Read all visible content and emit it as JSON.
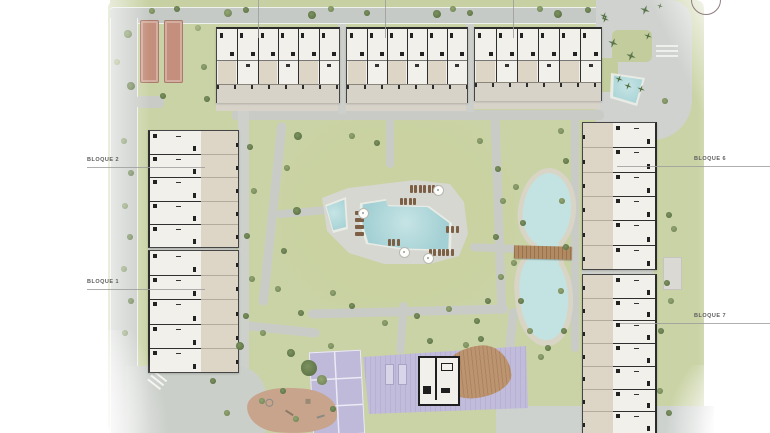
{
  "plan_title": "Residential masterplan",
  "colors": {
    "grass": "#cad3a6",
    "grass_light": "#d2daae",
    "grass_dark": "#c2cc9b",
    "road": "#c6cac6",
    "path": "#c9ccc6",
    "plaza": "#ced1ce",
    "deck": "#d6d7d0",
    "pool_rim": "#e9ebe5",
    "pool": "#a6d2d5",
    "pool_light": "#c6e4e5",
    "sand": "#d9d5c6",
    "lagoon": "#c2e3e1",
    "terrace": "#ddd6c6",
    "room": "#f2f0ea",
    "wall": "#2b2b2b",
    "plinth": "#d8d3c8",
    "purple": "#c2bcdc",
    "purple_line": "#eceaf4",
    "wood": "#bd9470",
    "bridge": "#b28a62",
    "play": "#c7a48b",
    "petanque": "#c48f7c",
    "lounger": "#7d5f46",
    "tree_dark": "#5e7547",
    "tree_mid": "#74885a",
    "tree_light": "#94a471",
    "palm": "#4a663d",
    "label": "#5c5c5c",
    "leader": "#9b9b9b"
  },
  "scene": {
    "labels": [
      {
        "text": "BLOQUE 2",
        "tx": 87,
        "ty": 158,
        "lx1": 87,
        "lx2": 205,
        "ly": 167
      },
      {
        "text": "BLOQUE 1",
        "tx": 87,
        "ty": 280,
        "lx1": 87,
        "lx2": 205,
        "ly": 289
      },
      {
        "text": "BLOQUE 6",
        "tx": 694,
        "ty": 157,
        "lx1": 617,
        "lx2": 770,
        "ly": 166
      },
      {
        "text": "BLOQUE 7",
        "tx": 694,
        "ty": 314,
        "lx1": 620,
        "lx2": 770,
        "ly": 323
      }
    ],
    "top_leaders": [
      258,
      385,
      513
    ],
    "buildings": [
      {
        "id": "bloque-3",
        "x": 216,
        "y": 27,
        "w": 122,
        "h": 73,
        "dir": "h",
        "units": 6
      },
      {
        "id": "bloque-4",
        "x": 346,
        "y": 27,
        "w": 120,
        "h": 73,
        "dir": "h",
        "units": 6
      },
      {
        "id": "bloque-5",
        "x": 474,
        "y": 27,
        "w": 126,
        "h": 71,
        "dir": "h",
        "units": 6
      },
      {
        "id": "bloque-2",
        "x": 148,
        "y": 130,
        "w": 88,
        "h": 116,
        "dir": "v",
        "terrace": "right",
        "units": 5
      },
      {
        "id": "bloque-1",
        "x": 148,
        "y": 250,
        "w": 88,
        "h": 121,
        "dir": "v",
        "terrace": "right",
        "units": 5
      },
      {
        "id": "bloque-6",
        "x": 582,
        "y": 122,
        "w": 72,
        "h": 146,
        "dir": "v",
        "terrace": "left",
        "units": 6
      },
      {
        "id": "bloque-7",
        "x": 582,
        "y": 274,
        "w": 72,
        "h": 159,
        "dir": "v",
        "terrace": "left",
        "units": 7
      }
    ],
    "trees": [
      [
        228,
        13,
        4,
        "m"
      ],
      [
        246,
        10,
        3,
        "d"
      ],
      [
        312,
        15,
        4,
        "d"
      ],
      [
        331,
        9,
        3,
        "m"
      ],
      [
        367,
        13,
        3,
        "d"
      ],
      [
        437,
        14,
        4,
        "d"
      ],
      [
        453,
        9,
        3,
        "m"
      ],
      [
        470,
        13,
        3,
        "d"
      ],
      [
        540,
        9,
        3,
        "m"
      ],
      [
        558,
        14,
        4,
        "d"
      ],
      [
        588,
        10,
        3,
        "d"
      ],
      [
        604,
        16,
        4,
        "p"
      ],
      [
        645,
        10,
        5,
        "p"
      ],
      [
        660,
        6,
        3,
        "p"
      ],
      [
        128,
        34,
        4,
        "m"
      ],
      [
        131,
        86,
        4,
        "d"
      ],
      [
        152,
        11,
        3,
        "m"
      ],
      [
        163,
        96,
        3,
        "d"
      ],
      [
        198,
        28,
        3,
        "l"
      ],
      [
        204,
        67,
        3,
        "m"
      ],
      [
        207,
        99,
        3,
        "d"
      ],
      [
        177,
        9,
        3,
        "d"
      ],
      [
        117,
        62,
        3,
        "l"
      ],
      [
        124,
        141,
        3,
        "m"
      ],
      [
        131,
        173,
        3,
        "d"
      ],
      [
        125,
        206,
        3,
        "m"
      ],
      [
        130,
        237,
        3,
        "d"
      ],
      [
        124,
        269,
        3,
        "m"
      ],
      [
        131,
        301,
        3,
        "d"
      ],
      [
        125,
        333,
        3,
        "m"
      ],
      [
        250,
        147,
        3,
        "d"
      ],
      [
        254,
        191,
        3,
        "m"
      ],
      [
        247,
        236,
        3,
        "d"
      ],
      [
        252,
        279,
        3,
        "m"
      ],
      [
        246,
        316,
        3,
        "d"
      ],
      [
        298,
        136,
        4,
        "d"
      ],
      [
        287,
        168,
        3,
        "m"
      ],
      [
        297,
        211,
        4,
        "d"
      ],
      [
        284,
        251,
        3,
        "d"
      ],
      [
        278,
        289,
        3,
        "m"
      ],
      [
        301,
        313,
        3,
        "d"
      ],
      [
        263,
        333,
        3,
        "m"
      ],
      [
        240,
        346,
        4,
        "d"
      ],
      [
        352,
        136,
        3,
        "m"
      ],
      [
        377,
        143,
        3,
        "d"
      ],
      [
        480,
        141,
        3,
        "m"
      ],
      [
        498,
        169,
        3,
        "d"
      ],
      [
        503,
        201,
        3,
        "m"
      ],
      [
        496,
        237,
        3,
        "d"
      ],
      [
        501,
        277,
        3,
        "m"
      ],
      [
        488,
        301,
        3,
        "d"
      ],
      [
        352,
        306,
        3,
        "d"
      ],
      [
        385,
        323,
        3,
        "m"
      ],
      [
        417,
        316,
        3,
        "d"
      ],
      [
        449,
        309,
        3,
        "m"
      ],
      [
        477,
        321,
        3,
        "d"
      ],
      [
        333,
        293,
        3,
        "m"
      ],
      [
        516,
        187,
        3,
        "m"
      ],
      [
        523,
        223,
        3,
        "d"
      ],
      [
        514,
        263,
        3,
        "m"
      ],
      [
        521,
        301,
        3,
        "d"
      ],
      [
        530,
        331,
        3,
        "m"
      ],
      [
        548,
        348,
        3,
        "d"
      ],
      [
        561,
        131,
        3,
        "m"
      ],
      [
        566,
        161,
        3,
        "d"
      ],
      [
        562,
        201,
        3,
        "m"
      ],
      [
        566,
        247,
        3,
        "d"
      ],
      [
        561,
        291,
        3,
        "m"
      ],
      [
        564,
        331,
        3,
        "d"
      ],
      [
        665,
        101,
        3,
        "m"
      ],
      [
        669,
        215,
        3,
        "d"
      ],
      [
        674,
        229,
        3,
        "m"
      ],
      [
        667,
        283,
        3,
        "d"
      ],
      [
        671,
        301,
        3,
        "m"
      ],
      [
        661,
        331,
        3,
        "d"
      ],
      [
        660,
        391,
        3,
        "m"
      ],
      [
        669,
        413,
        3,
        "d"
      ],
      [
        613,
        43,
        5,
        "p"
      ],
      [
        631,
        56,
        5,
        "p"
      ],
      [
        619,
        79,
        4,
        "p"
      ],
      [
        641,
        89,
        4,
        "p"
      ],
      [
        605,
        19,
        4,
        "p"
      ],
      [
        628,
        86,
        4,
        "p"
      ],
      [
        648,
        36,
        4,
        "p"
      ],
      [
        291,
        353,
        4,
        "d"
      ],
      [
        309,
        368,
        8,
        "d"
      ],
      [
        322,
        380,
        5,
        "m"
      ],
      [
        331,
        346,
        3,
        "m"
      ],
      [
        283,
        391,
        3,
        "d"
      ],
      [
        296,
        419,
        3,
        "m"
      ],
      [
        481,
        339,
        3,
        "d"
      ],
      [
        541,
        357,
        3,
        "m"
      ],
      [
        213,
        381,
        3,
        "d"
      ],
      [
        227,
        413,
        3,
        "m"
      ],
      [
        430,
        341,
        3,
        "d"
      ],
      [
        466,
        345,
        3,
        "m"
      ],
      [
        262,
        401,
        3,
        "m"
      ],
      [
        333,
        409,
        3,
        "d"
      ]
    ],
    "loungers": [
      {
        "x": 410,
        "y": 185,
        "n": 7,
        "dx": 4.4,
        "dy": 0,
        "w": 3,
        "h": 8
      },
      {
        "x": 400,
        "y": 198,
        "n": 4,
        "dx": 4.4,
        "dy": 0,
        "w": 3,
        "h": 7
      },
      {
        "x": 355,
        "y": 211,
        "n": 4,
        "dx": 0,
        "dy": 7,
        "w": 9,
        "h": 3.5
      },
      {
        "x": 446,
        "y": 226,
        "n": 3,
        "dx": 5,
        "dy": 0,
        "w": 3,
        "h": 7
      },
      {
        "x": 429,
        "y": 249,
        "n": 6,
        "dx": 4.3,
        "dy": 0,
        "w": 3,
        "h": 7
      },
      {
        "x": 388,
        "y": 239,
        "n": 3,
        "dx": 4.4,
        "dy": 0,
        "w": 3,
        "h": 7
      }
    ],
    "umbrellas": [
      [
        437,
        189
      ],
      [
        362,
        212
      ],
      [
        403,
        251
      ],
      [
        427,
        257
      ]
    ]
  }
}
